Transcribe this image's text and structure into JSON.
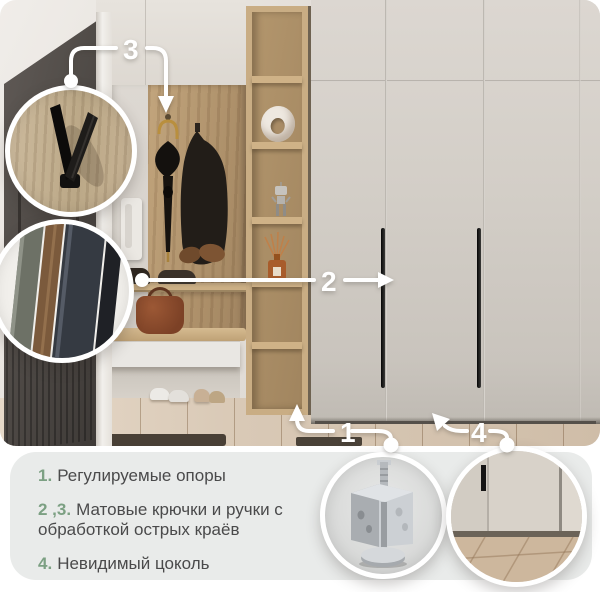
{
  "palette": {
    "accent_green": "#7ca083",
    "panel_bg": "#e9ebea",
    "annotation_white": "#ffffff",
    "wardrobe": "#d3cec7",
    "oak_wood": "#b79a72",
    "entry_door": "#4e4945"
  },
  "callouts": [
    {
      "id": "hooks",
      "number": "3",
      "icon": "wall-hook-closeup-icon"
    },
    {
      "id": "handles-edges",
      "number": "2",
      "icon": "handle-edge-closeup-icon"
    },
    {
      "id": "adjustable-feet",
      "number": "1",
      "icon": "adjustable-foot-closeup-icon"
    },
    {
      "id": "plinth",
      "number": "4",
      "icon": "recessed-plinth-closeup-icon"
    }
  ],
  "features": {
    "items": [
      {
        "num": "1.",
        "text": "Регулируемые опоры"
      },
      {
        "num": "2 ,3.",
        "text": "Матовые крючки и ручки с обработкой острых краёв"
      },
      {
        "num": "4.",
        "text": "Невидимый цоколь"
      }
    ]
  }
}
